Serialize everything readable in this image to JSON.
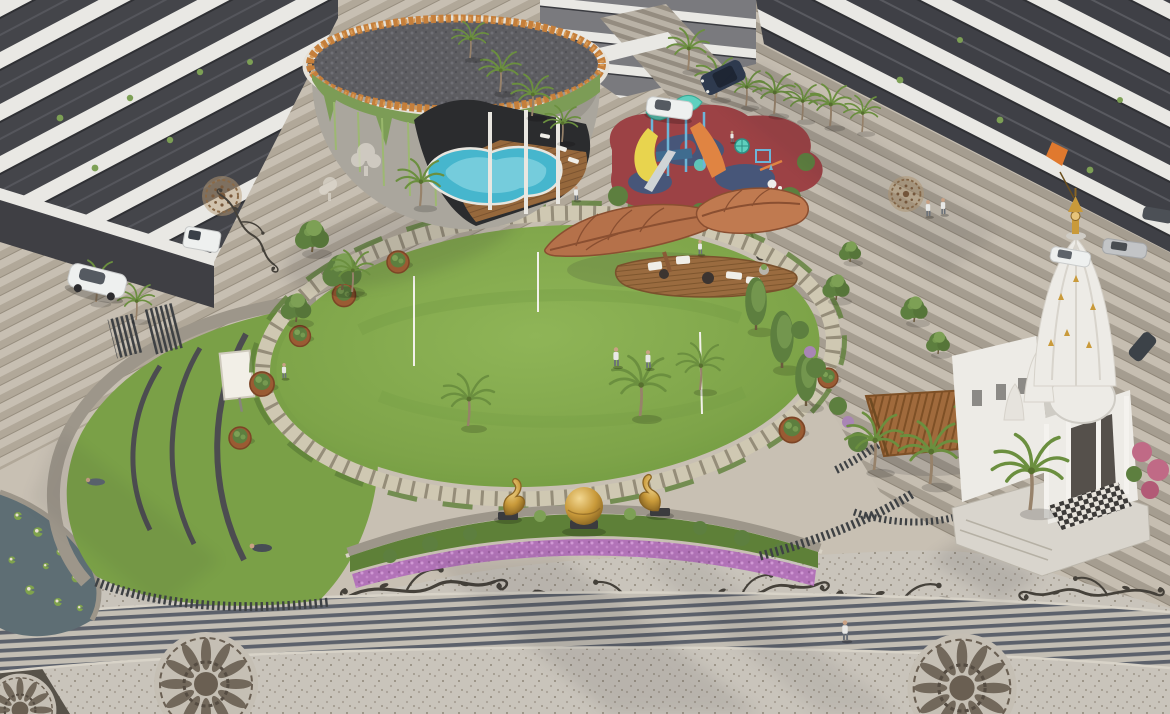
{
  "image": {
    "kind": "3d-architectural-render",
    "subject": "Aerial view of a residential complex landscaped central courtyard",
    "visible_text": ""
  },
  "palette": {
    "paving": "#c8c0b3",
    "pavingDark": "#a89f90",
    "plankLine": "#8f8678",
    "terrazzo": "#c9c4bb",
    "speckle": "#9e978b",
    "bandDark": "#5c616b",
    "bandLight": "#c3beb4",
    "ink": "#45413a",
    "medallionBrown": "#8a6a48",
    "mandalaBrown": "#6a5f52",
    "buildingWall": "#76767a",
    "buildingDark": "#44454a",
    "balconyWhite": "#e9e8e4",
    "windowDark": "#2f3034",
    "clubWall": "#aaa69d",
    "roofPebble": "#5d5d61",
    "flowerRing": "#c57f3b",
    "vine": "#7c9c56",
    "vineLight": "#9cba6e",
    "pool": "#46b6cd",
    "poolLight": "#8fd8e4",
    "deckWood": "#96683c",
    "deckLine": "#7c5430",
    "rubberRed": "#9c4245",
    "rubberBlue": "#475679",
    "canopyTeal": "#5fd0bf",
    "slideYellow": "#e8d44e",
    "slideOrange": "#e08442",
    "playBlue": "#6db5d8",
    "leafCanopy": "#b5714a",
    "leafVein": "#8a4f31",
    "lawn": "#7ea449",
    "lawnLight": "#8fb557",
    "lawnDark": "#6c9440",
    "ringPath": "#cfc8b2",
    "ringTick": "#958d79",
    "hedge": "#5e7f38",
    "treeGreen": "#5d7f3f",
    "treeLight": "#7da055",
    "palmGreen": "#6b8f3f",
    "trunk": "#97826a",
    "corten": "#9a5b33",
    "wallStone": "#9d968a",
    "benchDark": "#4c4c50",
    "screenWhite": "#f2efe7",
    "fence": "#3e4144",
    "pond": "#5e6e74",
    "lily": "#7fa34c",
    "flowerPurple": "#b273b8",
    "flowerPurpleLight": "#d097d4",
    "grassBed": "#5e8038",
    "gold": "#c99a3a",
    "goldLight": "#e6c37a",
    "goldDark": "#8a6524",
    "pedestal": "#3b3b3e",
    "temple": "#edebe6",
    "templeShade": "#cfccc5",
    "pinkBush": "#c06a86",
    "carWhite": "#eef0ef",
    "carDark": "#2e3a4e",
    "carSilver": "#c2c4c6",
    "skin": "#c9a184",
    "shirt": "#e8e8e6",
    "pants": "#6a7078",
    "shadow": "#2a2a33"
  },
  "scene": {
    "elements": [
      {
        "name": "apartment-building-left",
        "label": "Apartment building with curved white balconies (top left)"
      },
      {
        "name": "apartment-building-center",
        "label": "Apartment block with entrance steps (top center)"
      },
      {
        "name": "apartment-building-right",
        "label": "Apartment building with balcony bands (top right)"
      },
      {
        "name": "clubhouse",
        "label": "Round clubhouse with pebble roof, flower ring and hanging vines"
      },
      {
        "name": "swimming-pool",
        "label": "Freeform blue pool with wooden deck inside clubhouse arch"
      },
      {
        "name": "playground",
        "label": "Children's playground on red and blue rubber surface"
      },
      {
        "name": "leaf-canopy",
        "label": "Leaf-shaped timber shade canopies"
      },
      {
        "name": "wood-deck",
        "label": "Leaf-shaped seating deck with white loungers"
      },
      {
        "name": "central-lawn",
        "label": "Large oval central lawn"
      },
      {
        "name": "lawn-ring-path",
        "label": "Paver ring path around the lawn"
      },
      {
        "name": "amphitheater-lawn",
        "label": "Terraced amphitheater lawn mound"
      },
      {
        "name": "projection-screen",
        "label": "Outdoor movie screen on lawn"
      },
      {
        "name": "lily-pond",
        "label": "Curved lily pond at lower left"
      },
      {
        "name": "flower-bed",
        "label": "Curved bed of purple flowers and shrubs"
      },
      {
        "name": "gold-sphere-sculpture",
        "label": "Golden sphere sculpture on plinth"
      },
      {
        "name": "swan-sculpture",
        "label": "Golden abstract swan sculptures"
      },
      {
        "name": "temple",
        "label": "White marble temple with gold spire"
      },
      {
        "name": "pergola",
        "label": "Timber pergola near temple"
      },
      {
        "name": "promenade",
        "label": "Terrazzo promenade with inlay patterns"
      },
      {
        "name": "stripe-walkway",
        "label": "Striped walkway band"
      },
      {
        "name": "mandala-inlay",
        "label": "Mandala paving medallions"
      },
      {
        "name": "vine-inlay",
        "label": "Vine scroll paving inlays"
      },
      {
        "name": "palm-tree",
        "label": "Palm trees"
      },
      {
        "name": "tree",
        "label": "Garden trees"
      },
      {
        "name": "planter",
        "label": "Round corten planters"
      },
      {
        "name": "car",
        "label": "Parked and moving cars"
      },
      {
        "name": "person",
        "label": "Residents walking and relaxing"
      }
    ]
  }
}
